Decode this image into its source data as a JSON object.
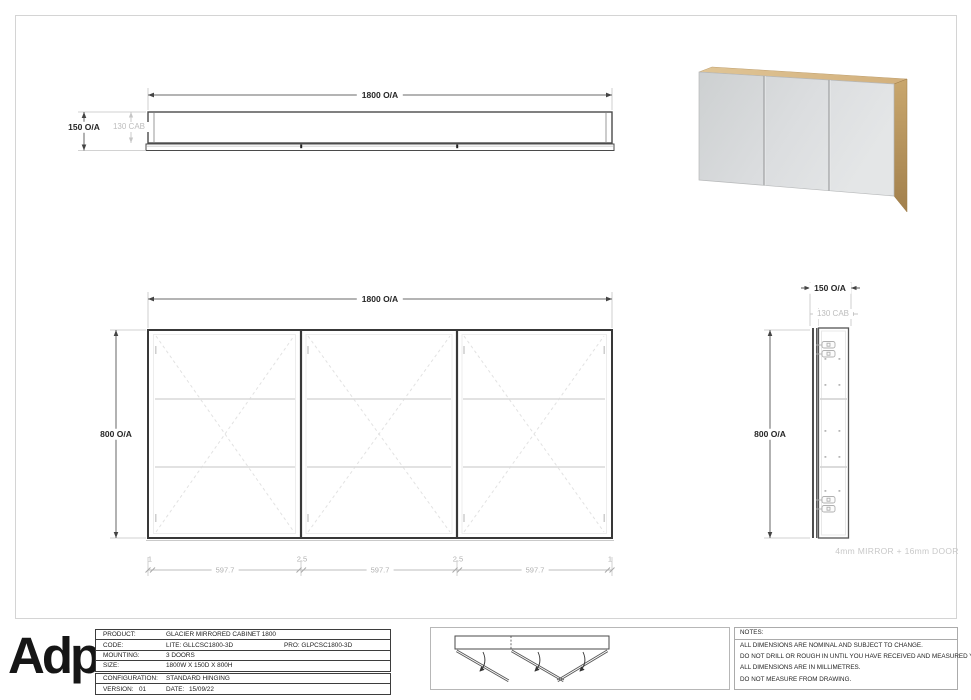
{
  "top_view": {
    "width_dim": "1800 O/A",
    "overall_depth_dim": "150 O/A",
    "cabinet_depth_dim": "130 CAB"
  },
  "front_view": {
    "width_dim": "1800 O/A",
    "height_dim": "800 O/A",
    "bottom_dims": [
      "1",
      "597.7",
      "2.5",
      "597.7",
      "2.5",
      "597.7",
      "1"
    ]
  },
  "side_view": {
    "overall_depth_dim": "150 O/A",
    "cabinet_depth_dim": "130 CAB",
    "height_dim": "800 O/A",
    "caption": "4mm MIRROR + 16mm DOOR"
  },
  "title_block": {
    "logo_text": "Adp",
    "rows": {
      "product": {
        "label": "PRODUCT:",
        "value": "GLACIER MIRRORED CABINET 1800"
      },
      "code": {
        "label": "CODE:",
        "value_lite": "LITE: GLLCSC1800-3D",
        "value_pro": "PRO: GLPCSC1800-3D"
      },
      "mounting": {
        "label": "MOUNTING:",
        "value": "3 DOORS"
      },
      "size": {
        "label": "SIZE:",
        "value": "1800W X 150D X 800H"
      },
      "configuration": {
        "label": "CONFIGURATION:",
        "value": "STANDARD HINGING"
      },
      "version": {
        "label": "VERSION:",
        "value": "01",
        "date_label": "DATE:",
        "date_value": "15/09/22"
      }
    }
  },
  "notes_box": {
    "title": "NOTES:",
    "lines": [
      "ALL DIMENSIONS ARE NOMINAL AND SUBJECT TO CHANGE.",
      "DO NOT DRILL OR ROUGH IN UNTIL YOU HAVE RECEIVED AND MEASURED YOUR PRODUCT.",
      "ALL DIMENSIONS ARE IN MILLIMETRES.",
      "DO NOT MEASURE FROM DRAWING."
    ]
  },
  "colors": {
    "dim_text": "#262626",
    "dim_grey": "#bdbdbd",
    "line_dark": "#3f3f3f",
    "line_light": "#d9d9d9",
    "wood": "#c7a267",
    "mirror": "#d7d9da"
  }
}
